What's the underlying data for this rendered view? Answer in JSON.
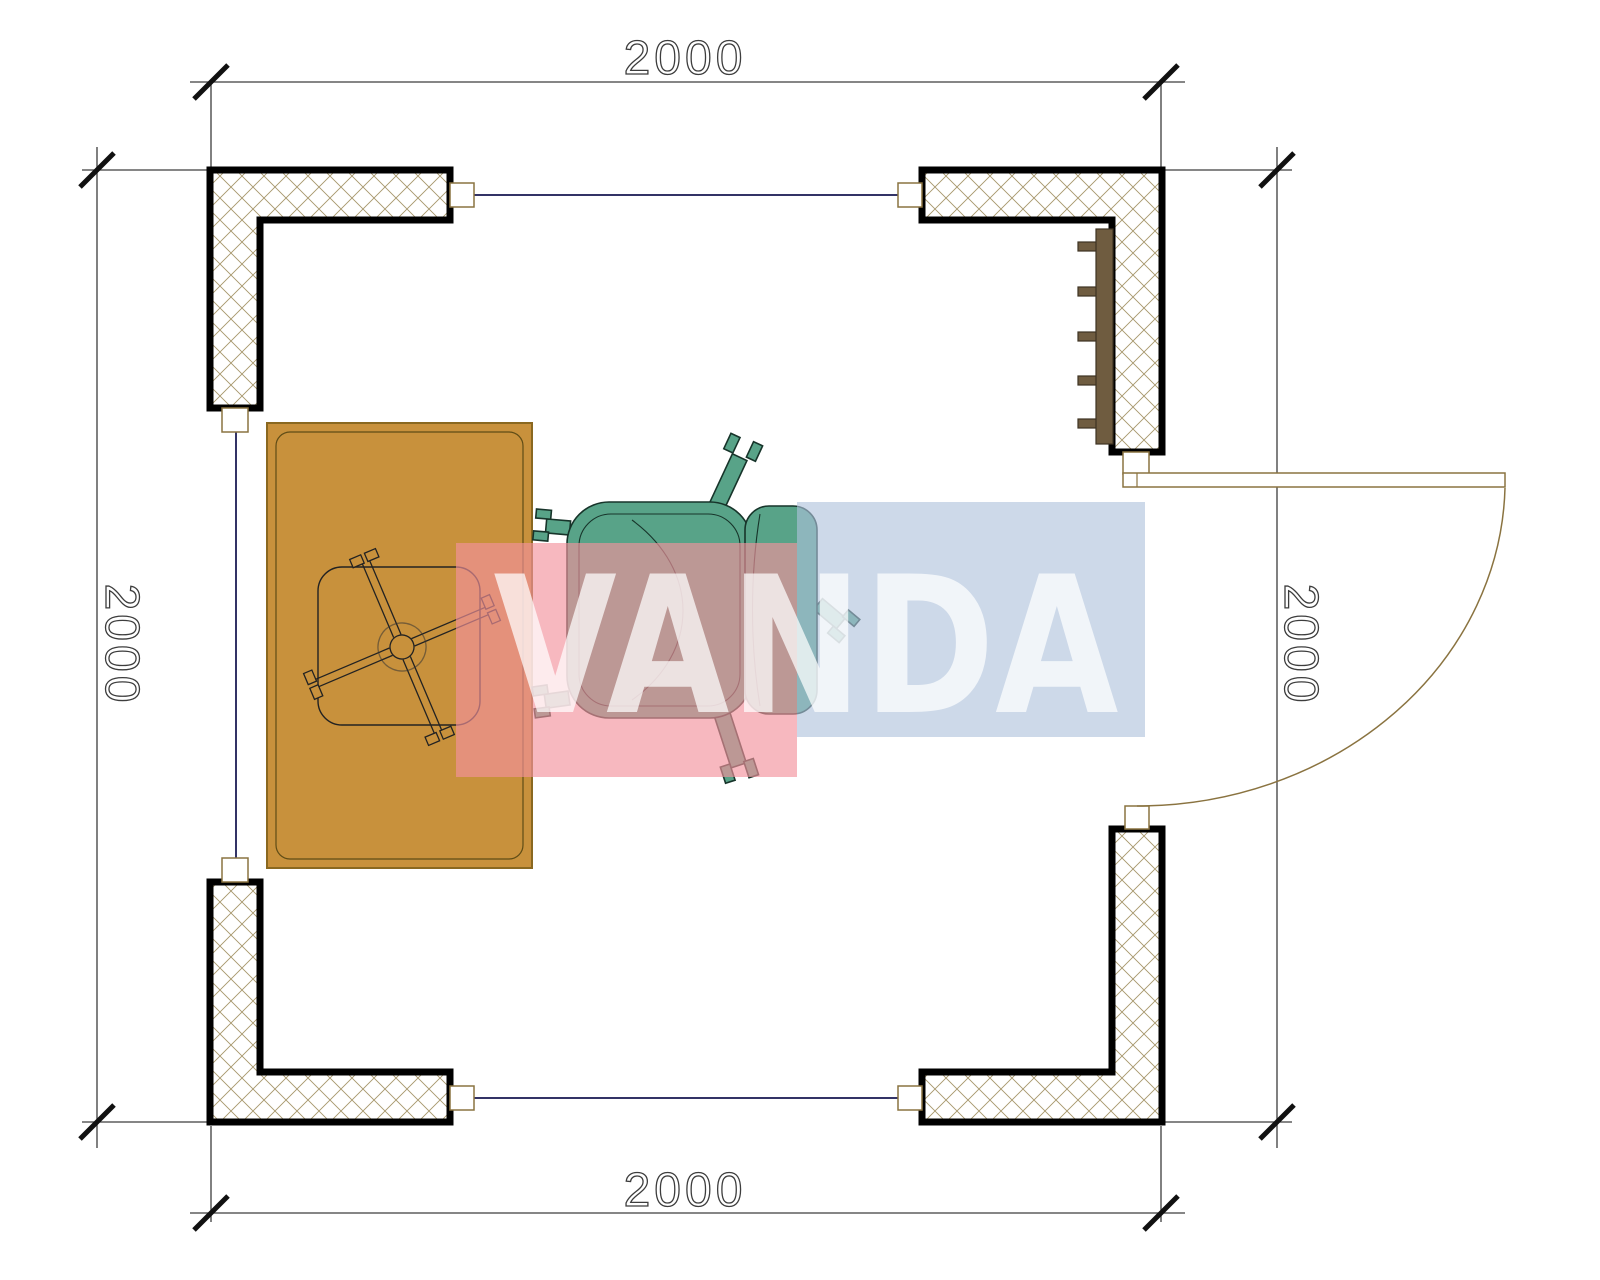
{
  "plan": {
    "dimensions": {
      "top": "2000",
      "bottom": "2000",
      "left": "2000",
      "right": "2000"
    },
    "watermark": {
      "text": "VANDA",
      "pink": "#f3929d",
      "blue": "#aec1db",
      "letters": "#ffffff"
    },
    "colors": {
      "wall_outline": "#000000",
      "hatch_line": "#a6966b",
      "connector_line": "#333366",
      "frame_outline": "#8a7340",
      "dimension_line": "#3d3d3d",
      "table_fill": "#c8913c",
      "table_edge": "#8a6820",
      "chair_fill": "#58a388",
      "chair_edge": "#17342a",
      "radiator_fill": "#6f5c40"
    },
    "objects": [
      {
        "name": "corner-wall-top-left"
      },
      {
        "name": "corner-wall-top-right"
      },
      {
        "name": "corner-wall-bottom-left"
      },
      {
        "name": "corner-wall-bottom-right"
      },
      {
        "name": "radiator"
      },
      {
        "name": "door-leaf"
      },
      {
        "name": "door-swing-arc"
      },
      {
        "name": "desk"
      },
      {
        "name": "desk-chair-base"
      },
      {
        "name": "office-chair"
      }
    ]
  }
}
